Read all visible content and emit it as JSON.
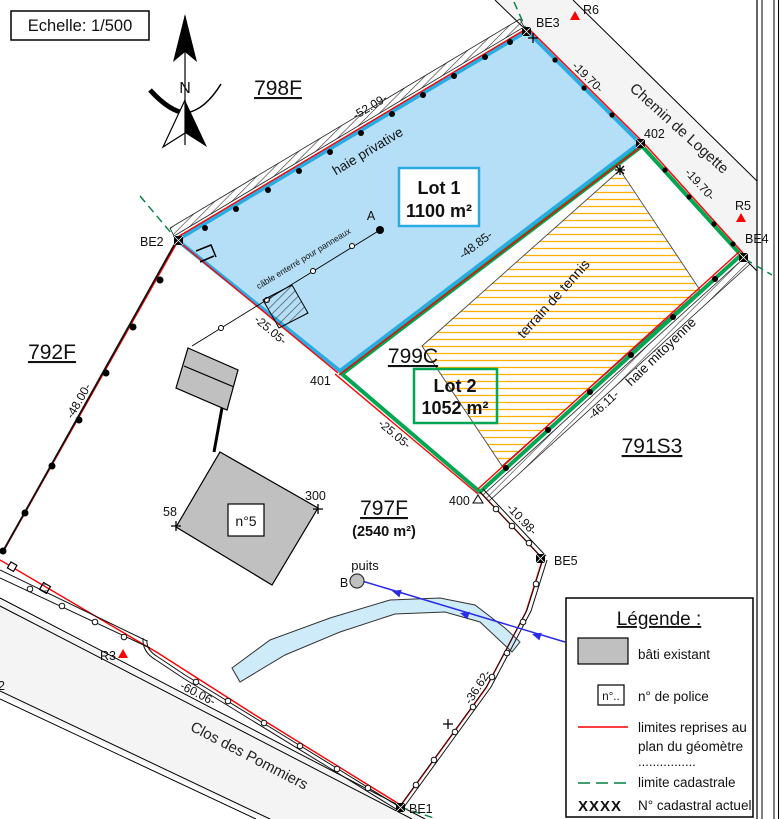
{
  "scale_box": {
    "label": "Echelle: 1/500"
  },
  "compass": {
    "north_label": "N"
  },
  "parcels": {
    "p798": "798F",
    "p792": "792F",
    "p799": "799C",
    "p791": "791S3",
    "p797": "797F",
    "p797_area": "(2540 m²)"
  },
  "lots": {
    "lot1": {
      "name": "Lot 1",
      "area": "1100 m²"
    },
    "lot2": {
      "name": "Lot 2",
      "area": "1052 m²"
    }
  },
  "roads": {
    "chemin_de_logette": "Chemin de Logette",
    "clos_des_pommiers": "Clos des Pommiers"
  },
  "features": {
    "haie_privative": "haie privative",
    "haie_mitoyenne": "haie mitoyenne",
    "tennis": "terrain de tennis",
    "cable": "câble enterré pour panneaux",
    "puits": "puits",
    "house_number": "n°5"
  },
  "points": {
    "A": "A",
    "B": "B",
    "BE1": "BE1",
    "BE2": "BE2",
    "BE3": "BE3",
    "BE4": "BE4",
    "BE5": "BE5",
    "R3": "R3",
    "R5": "R5",
    "R6": "R6",
    "p58": "58",
    "p300": "300",
    "p400": "400",
    "p401": "401",
    "p402": "402",
    "p2": "2"
  },
  "measurements": {
    "m5209": "-52.09-",
    "m1970a": "-19.70-",
    "m1970b": "-19.70-",
    "m4885": "-48.85-",
    "m2505a": "-25.05-",
    "m2505b": "-25.05-",
    "m4800": "-48.00-",
    "m4611": "-46.11-",
    "m1098": "-10.98-",
    "m3662": "-36.62-",
    "m6006": "-60.06-"
  },
  "legend": {
    "title": "Légende :",
    "bati": "bâti existant",
    "police_box": "n°..",
    "police": "n° de police",
    "limites_line1": "limites reprises au",
    "limites_line2": "plan du géomètre",
    "dots_row": "................",
    "cadastrale": "limite cadastrale",
    "xxxx": "XXXX",
    "cadastral_actuel": "N° cadastral actuel"
  },
  "colors": {
    "parcel_magenta": "#C800C8",
    "measure_red": "#FF0000",
    "measure_brown": "#A87B2D",
    "lot1_cyan": "#29ABE2",
    "lot1_fill": "#B5DFF7",
    "lot2_green": "#00A651",
    "cadastral_dash_green": "#008040",
    "tennis_orange": "#FFA800",
    "road_fill": "#F4F4F4",
    "building_gray": "#C0C0C0",
    "stream_blue": "#CDEBF8",
    "arrow_blue": "#2B2BE8"
  }
}
